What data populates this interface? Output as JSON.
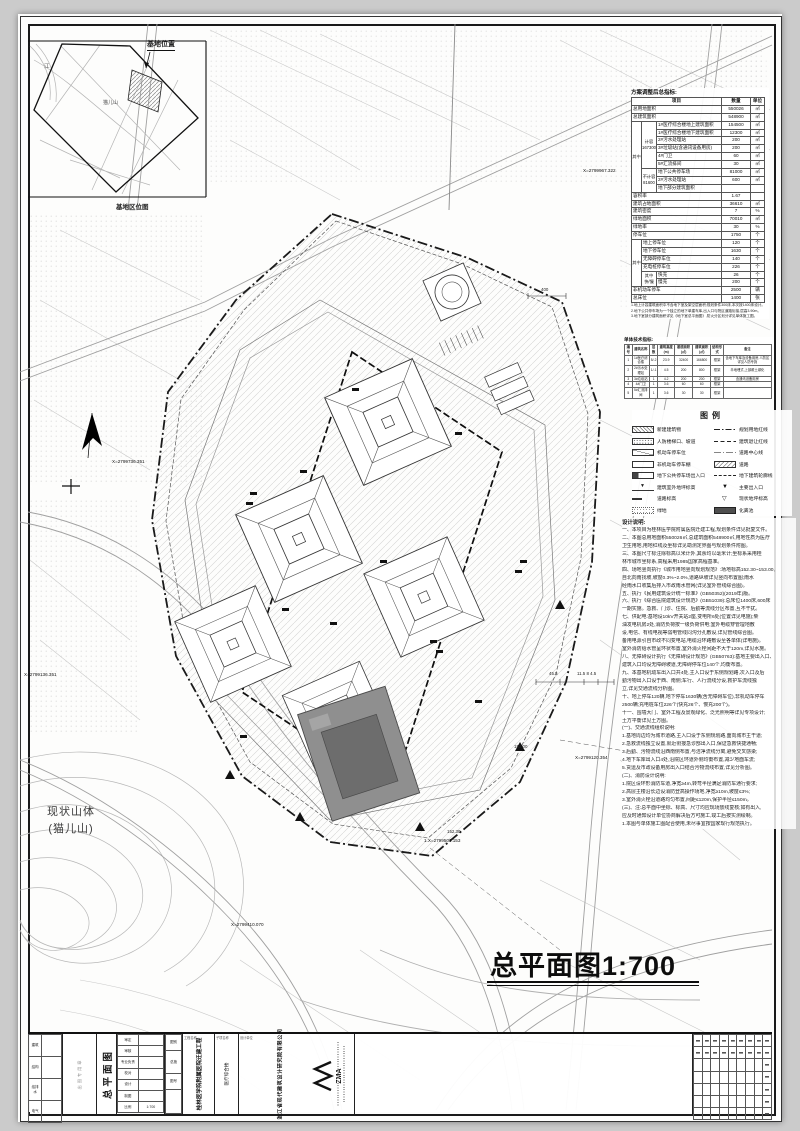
{
  "sheet": {
    "page_bg": "#cbcbcb",
    "paper": "#fdfdfc",
    "line_color": "#1a1a1a"
  },
  "inset_map": {
    "title": "基地位置",
    "area_label": "基地区位图",
    "river_label": "江",
    "peak_label": "猫儿山"
  },
  "main_title": {
    "text": "总平面图1:700"
  },
  "mountain_label": {
    "line1": "现状山体",
    "line2": "(猫儿山)"
  },
  "metrics_table": {
    "title": "方案调整后总指标:",
    "headers": [
      "项目",
      "数量",
      "单位"
    ],
    "rows": [
      {
        "label": "总用地面积",
        "qty": "550026",
        "unit": "㎡"
      },
      {
        "label": "总建筑面积",
        "qty": "548900",
        "unit": "㎡"
      },
      {
        "stub1": {
          "text": "其中",
          "span": 9
        },
        "stub2": {
          "text": "计容\n167300",
          "span": 6
        },
        "label": "1#医疗综合楼地上建筑面积",
        "qty": "154500",
        "unit": "㎡"
      },
      {
        "label": "1#医疗综合楼地下建筑面积",
        "qty": "12300",
        "unit": "㎡"
      },
      {
        "label": "2#污水处理站",
        "qty": "200",
        "unit": "㎡"
      },
      {
        "label": "3#垃圾站(含通讯设备用房)",
        "qty": "200",
        "unit": "㎡"
      },
      {
        "label": "4#门卫",
        "qty": "60",
        "unit": "㎡"
      },
      {
        "label": "5#汇流排间",
        "qty": "30",
        "unit": "㎡"
      },
      {
        "stub2": {
          "text": "不计容\n81600",
          "span": 3
        },
        "label": "地下公共停车场",
        "qty": "81000",
        "unit": "㎡"
      },
      {
        "label": "2#污水处理站",
        "qty": "600",
        "unit": "㎡"
      },
      {
        "label": "地下部分建筑面积",
        "qty": "",
        "unit": ""
      },
      {
        "label": "容积率",
        "qty": "1.67",
        "unit": ""
      },
      {
        "label": "建筑占地面积",
        "qty": "36610",
        "unit": "㎡"
      },
      {
        "label": "建筑密度",
        "qty": "7",
        "unit": "%"
      },
      {
        "label": "绿地面积",
        "qty": "70010",
        "unit": "㎡"
      },
      {
        "label": "绿地率",
        "qty": "30",
        "unit": "%"
      },
      {
        "label": "停车位",
        "qty": "1750",
        "unit": "个"
      },
      {
        "stub1": {
          "text": "其中",
          "span": 6
        },
        "label": "地上停车位",
        "qty": "120",
        "unit": "个"
      },
      {
        "label": "地下停车位",
        "qty": "1630",
        "unit": "个"
      },
      {
        "label": "无障碍停车位",
        "qty": "140",
        "unit": "个"
      },
      {
        "label": "充电桩停车位",
        "qty": "226",
        "unit": "个"
      },
      {
        "stub2": {
          "text": "其中\n快/慢",
          "span": 2
        },
        "label": "快充",
        "qty": "26",
        "unit": "个"
      },
      {
        "label": "慢充",
        "qty": "200",
        "unit": "个"
      },
      {
        "label": "非机动车停车",
        "qty": "2500",
        "unit": "辆"
      },
      {
        "label": "总床位",
        "qty": "1400",
        "unit": "张"
      }
    ],
    "notes": [
      "1.地上计容建筑面积中不含地下室及架空层面积;规划条件300床,本次按1400床设计。",
      "2.地下公共停车场为一个独立的地下单建车库,出入口与院区道路衔接,层高3.90m。",
      "3.地下室部分建筑面积详见《地下室总平面图》,防火分区划分详见单体施工图。"
    ]
  },
  "unit_table": {
    "title": "单体技术指标:",
    "headers": [
      "编号",
      "建筑名称",
      "层数",
      "建筑高度(m)",
      "基底面积(㎡)",
      "建筑面积(㎡)",
      "结构形式",
      "备注"
    ],
    "rows": [
      [
        "1",
        "1#医疗综合楼",
        "5/-2",
        "23.9",
        "32400",
        "166800",
        "框架",
        "含地下车库及设备用房,人防区详见人防专篇"
      ],
      [
        "2",
        "2#污水处理站",
        "1/-1",
        "4.5",
        "200",
        "800",
        "框架",
        "半地埋式,上部覆土绿化"
      ],
      [
        "3",
        "3#垃圾站",
        "1",
        "4.2",
        "200",
        "200",
        "框架",
        "含通讯设备用房"
      ],
      [
        "4",
        "4#门卫",
        "1",
        "3.6",
        "60",
        "60",
        "框架",
        ""
      ],
      [
        "5",
        "5#汇流排间",
        "1",
        "3.6",
        "30",
        "30",
        "框架",
        ""
      ]
    ]
  },
  "legend": {
    "title": "图例",
    "left_items": [
      {
        "sym": "hatch-rect",
        "label": "新建建筑物"
      },
      {
        "sym": "dot-rect",
        "label": "人防楼梯口、坡道"
      },
      {
        "sym": "diag-rect",
        "label": "机动车停车位"
      },
      {
        "sym": "plain-rect",
        "label": "非机动车停车棚"
      },
      {
        "sym": "entry-rect",
        "label": "地下公共停车场出入口"
      },
      {
        "sym": "level-mark",
        "label": "建筑室外地坪标高"
      },
      {
        "sym": "slope-mark",
        "label": "道路标高"
      },
      {
        "sym": "green-rect",
        "label": "绿地"
      }
    ],
    "right_items": [
      {
        "sym": "dashdot-line",
        "label": "规划用地红线"
      },
      {
        "sym": "dash-line",
        "label": "建筑退让红线"
      },
      {
        "sym": "center-line",
        "label": "道路中心线"
      },
      {
        "sym": "road-hatch",
        "label": "道路"
      },
      {
        "sym": "outline-dash",
        "label": "地下建筑轮廓线"
      },
      {
        "sym": "tri-solid",
        "label": "主要出入口"
      },
      {
        "sym": "tri-open",
        "label": "现状地坪标高"
      },
      {
        "sym": "dark-rect",
        "label": "化粪池"
      }
    ]
  },
  "design_notes": {
    "title": "设计说明:",
    "lines": [
      "一、本项目为桂林医学院附属医院迁建工程,规划条件详见批复文件。",
      "二、本图总用地面积550026㎡,总建筑面积548900㎡,用地性质为医疗",
      "  卫生用地,用地红线及坐标详见勘测定界图与规划条件附图。",
      "三、本图尺寸标注除标高以米计外,其余均以毫米计;坐标系采用桂",
      "  林市城市坐标系,高程采用1985国家高程基准。",
      "四、场地竖向执行《城市用地竖向规划规范》:场地标高152.30~153.00,",
      "  自北向南找坡,坡度0.3%~2.0%,道路纵坡详见竖向布置图;雨水",
      "  经雨水口收集后排入市政雨水管网(详见室外管线综合图)。",
      "五、执行《民用建筑设计统一标准》(GB50352)(2019年)版。",
      "六、执行《综合医院建筑设计规范》(GB51039):总床位1400床,600床",
      "  一期实施。急救、门诊、住院、后勤等流线分区布置,互不干扰。",
      "七、供配电:基地设10kV开关站2座,变电所6处(位置详见电施);柴",
      "  油发电机房2处,消防负荷按一级负荷供电;室外电缆穿管埋地敷",
      "  设,电信、有线电视等弱电管线同沟分孔敷设,详见管线综合图。",
      "  备用电源引自市政不同变电站,电缆沿环路敷设至各单体(详电施)。",
      "  室外消防给水管呈环状布置,室外消火栓间距不大于120m,详见水施。",
      "八、无障碍设计执行《无障碍设计规范》(GB50763):基地主要出入口、",
      "  建筑入口均设无障碍坡道,无障碍停车位140个,均衡布置。",
      "九、本基地机动车出入口共4处,主入口设于东侧规划路,次入口及后",
      "  勤污物出入口设于西、南侧;车行、人行流线分设,救护车流线独",
      "  立,详见交通流线分析图。",
      "十、地上停车120辆,地下停车1630辆(含无障碍车位),非机动车停车",
      "  2500辆;充电桩车位226个(快充26个、慢充200个)。",
      "十一、围墙大门、室外工程及景观绿化、泛光照明等详见专项设计;",
      "  土方平衡详见土方图。",
      "(一)、交通流线组织说明:",
      "  1.基地周边均为城市道路,主入口设于东侧规划路,面向城市主干道;",
      "  2.急救流线独立设置,就近衔接急诊部出入口,保证急救快捷通畅;",
      "  3.后勤、污物流线沿西南侧布置,与洁净流线分离,避免交叉感染;",
      "  4.地下车库出入口4处,沿院区环道外侧均衡布置,减少地面车流;",
      "  5.货运及市政设备用房出入口结合污物流线布置,详见分析图。",
      "(二)、消防设计说明:",
      "  1.院区设环形消防车道,净宽≥4m,转弯半径满足消防车通行要求;",
      "  2.高层主楼沿长边设消防登高操作场地,净宽≥10m,坡度≤3%;",
      "  3.室外消火栓沿道路均匀布置,间距≤120m,保护半径≤150m。",
      "(三)、注:总平面中坐标、标高、尺寸均应现场放线复核;如有出入,",
      "  应及时通知设计单位协商解决后方可施工,竣工后按实测绘制。",
      "1.本图与单体施工图配合使用,未尽事宜按国家现行规范执行。"
    ]
  },
  "plan_labels": {
    "coords": [
      {
        "text": "X=2799967.322",
        "x": 583,
        "y": 168
      },
      {
        "text": "X=2799736.351",
        "x": 112,
        "y": 459
      },
      {
        "text": "X=2799136.351",
        "x": 24,
        "y": 672
      },
      {
        "text": "X=2799120.354",
        "x": 575,
        "y": 755
      },
      {
        "text": "1.X=2799503.153",
        "x": 424,
        "y": 838
      },
      {
        "text": "X=2799410.070",
        "x": 231,
        "y": 922
      }
    ],
    "dims": [
      {
        "text": "400",
        "x": 541,
        "y": 287
      },
      {
        "text": "45.5",
        "x": 549,
        "y": 671
      },
      {
        "text": "11.5  8  4.5",
        "x": 577,
        "y": 671
      },
      {
        "text": "152.30",
        "x": 447,
        "y": 829
      },
      {
        "text": "153.00",
        "x": 514,
        "y": 744
      }
    ]
  },
  "title_block": {
    "sign_labels": [
      "建筑",
      "结构",
      "给排水",
      "电气"
    ],
    "stamp_label": "出图专用章",
    "drawing_name": "总平面图",
    "review_rows": [
      [
        "审定",
        ""
      ],
      [
        "审核",
        ""
      ],
      [
        "专业负责",
        ""
      ],
      [
        "校对",
        ""
      ],
      [
        "设计",
        ""
      ],
      [
        "制图",
        ""
      ],
      [
        "比例",
        "1:700"
      ]
    ],
    "class_rows": [
      [
        "图别",
        "总施"
      ],
      [
        "图号",
        ""
      ]
    ],
    "project_label": "工程名称",
    "project_name": "桂林医学院附属医院迁建工程",
    "item_label": "子项名称",
    "item_name": "医疗综合楼",
    "company_label": "设计单位",
    "company": "浙江省现代建筑设计研究院有限公司",
    "logo_text": "ZMA",
    "sign_grid": {
      "cols": 9,
      "rows": 7
    }
  }
}
